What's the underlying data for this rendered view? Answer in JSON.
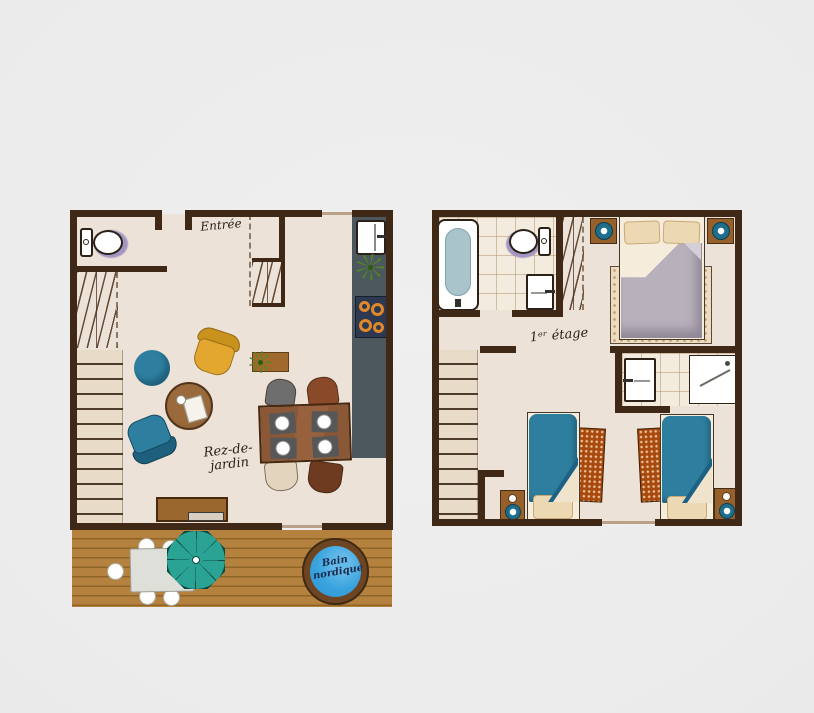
{
  "plans": {
    "ground": {
      "entrance_label": "Entrée",
      "name_line1": "Rez-de-",
      "name_line2": "jardin",
      "hot_tub_line1": "Bain",
      "hot_tub_line2": "nordique"
    },
    "first": {
      "name": "1ᵉʳ étage"
    }
  },
  "palette": {
    "bg": "#ebebeb",
    "floor": "#ece2d7",
    "wall": "#402817",
    "tile_bg": "#f3ebdd",
    "step_bg": "#e8dcc8",
    "deck": "#b5813e",
    "deck_line": "#8f6527",
    "teal": "#2e7f9f",
    "teal_dark": "#1d6285",
    "mustard": "#e3a72f",
    "counter": "#4d575e",
    "stove": "#2c3950",
    "burner": "#e0882a",
    "purple": "#a396c2",
    "tub_rim": "#6e4522",
    "tub_water": "#39a3de",
    "parasol": "#2aa394",
    "duvet_gray": "#b8b1bc",
    "sheet": "#f5ecdc",
    "pillow": "#ecd9b4",
    "pillow_line": "#c8a977",
    "rug_sand": "#ecdcc0",
    "rug_orange": "#a8490f",
    "table_wood": "#8a5837",
    "ink": "#2b2118"
  },
  "icons": {
    "toilet-icon": "css-shape",
    "bathtub-icon": "css-shape",
    "sink-icon": "css-shape",
    "shower-icon": "css-shape",
    "stove-icon": "css-rings",
    "plant-icon": "css-starburst",
    "parasol-icon": "css-octagon",
    "lamp-icon": "css-circle"
  }
}
